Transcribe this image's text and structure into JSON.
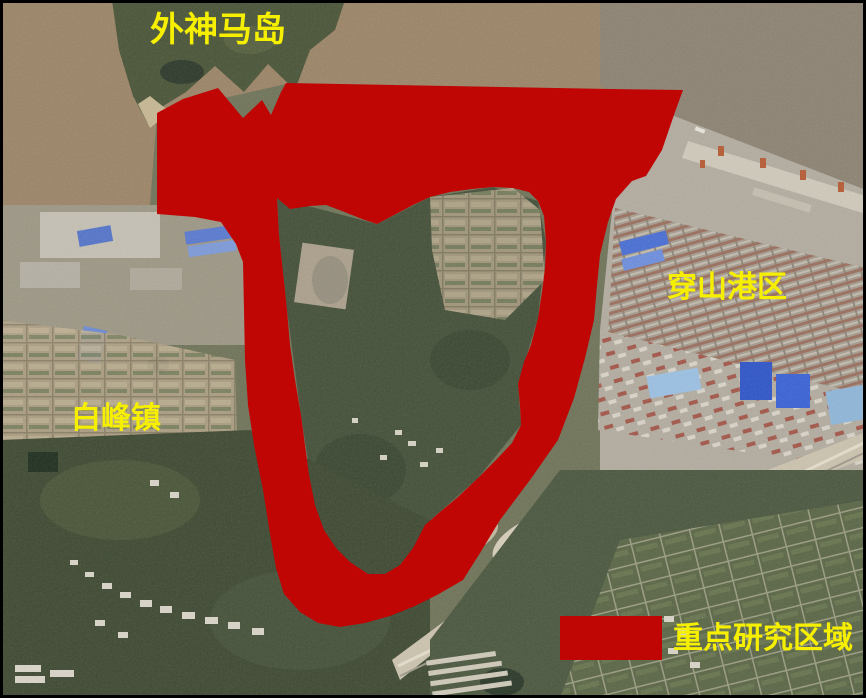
{
  "map": {
    "type": "satellite-annotation-figure",
    "labels": {
      "island": "外神马岛",
      "port": "穿山港区",
      "town": "白峰镇"
    },
    "legend": {
      "label": "重点研究区域"
    },
    "colors": {
      "overlay_red": "#C00505",
      "label_yellow": "#F6F000",
      "sea_brown": "#9C8568",
      "harbor_water": "#8D8373",
      "forest_green": "#45513A",
      "border_black": "#000000"
    }
  }
}
